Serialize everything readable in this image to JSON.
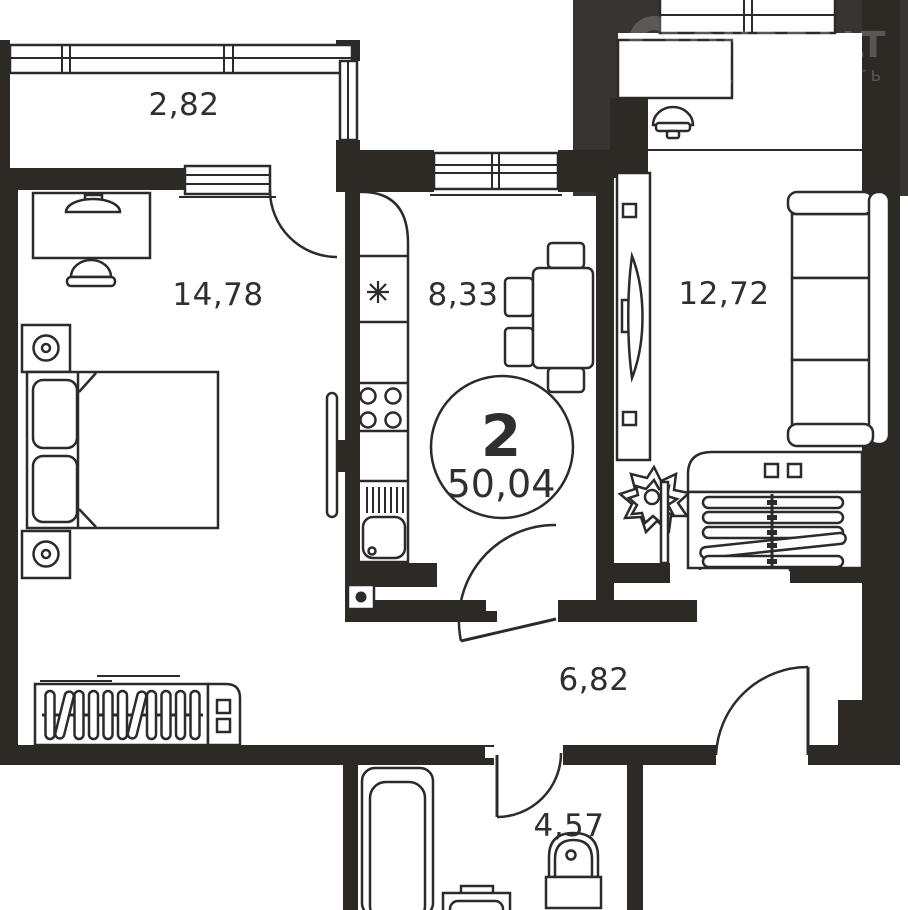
{
  "floor_plan": {
    "badge": {
      "rooms_count": "2",
      "total_area": "50,04"
    },
    "rooms": [
      {
        "name": "balcony",
        "area": "2,82"
      },
      {
        "name": "bedroom",
        "area": "14,78"
      },
      {
        "name": "kitchen",
        "area": "8,33"
      },
      {
        "name": "living-room",
        "area": "12,72"
      },
      {
        "name": "hallway",
        "area": "6,82"
      },
      {
        "name": "bathroom",
        "area": "4,57"
      }
    ]
  },
  "watermark": {
    "brand": "ONREALT",
    "tagline": "НЕДВИЖИМОСТЬ"
  },
  "colors": {
    "wall": "#2d2925",
    "outside_background": "#383431",
    "line": "#2b2b2b",
    "label_text": "#2f2f2f",
    "paper": "#ffffff"
  }
}
